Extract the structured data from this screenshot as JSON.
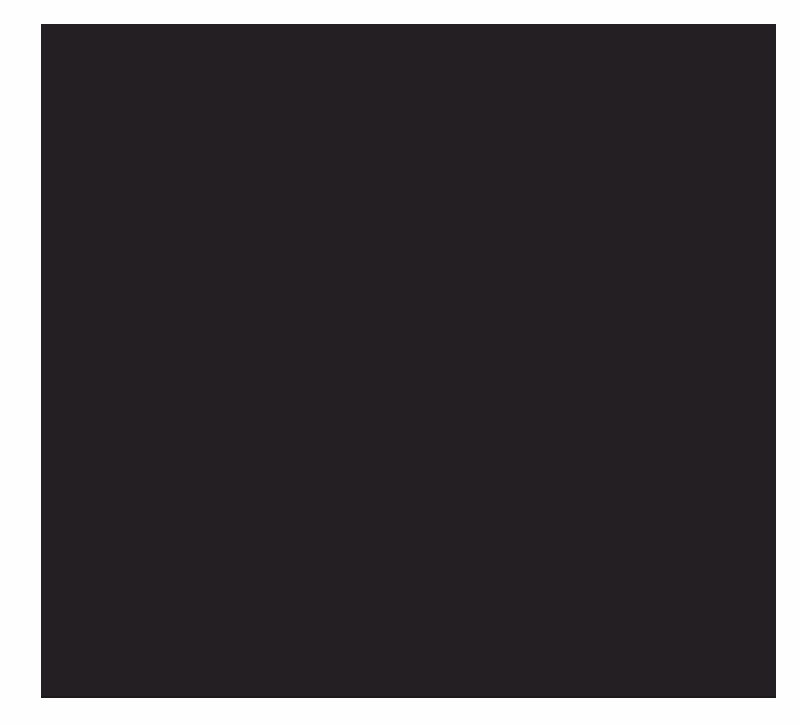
{
  "page": {
    "background_color": "#fefefe"
  },
  "panel": {
    "color": "#241f22",
    "bottom_edge_color": "#1d191b",
    "style": "background-color:#241f22;",
    "bottom_edge_style": "background-color:#1d191b;"
  }
}
